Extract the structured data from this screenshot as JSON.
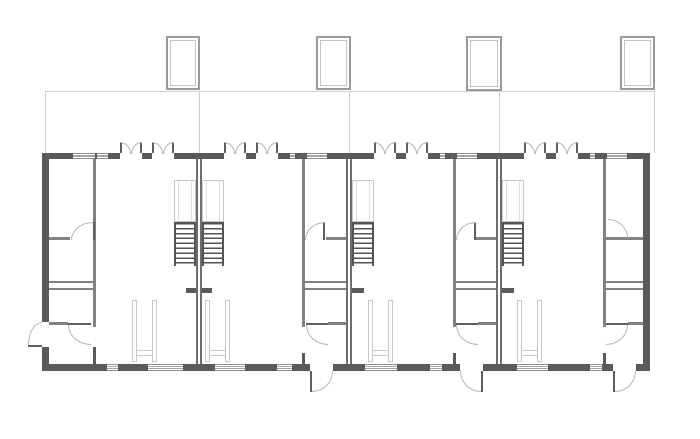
{
  "scene": {
    "width": 700,
    "height": 439,
    "background": "#ffffff"
  },
  "colors": {
    "exterior_wall": "#5a5a5a",
    "interior_wall": "#828282",
    "faint_line": "#cfcfcf",
    "door_arc": "#b5b5b5",
    "door_leaf": "#5f5f5f",
    "furniture_outline": "#c9c9c9"
  },
  "roof_objects": {
    "chimneys": [
      [
        166,
        36,
        34,
        54
      ],
      [
        316,
        36,
        35,
        54
      ],
      [
        466,
        36,
        36,
        55
      ],
      [
        620,
        36,
        35,
        54
      ]
    ]
  },
  "garden": {
    "hline": [
      45,
      91,
      610,
      1
    ],
    "vlines": [
      [
        45,
        91,
        1,
        62
      ],
      [
        199,
        91,
        1,
        62
      ],
      [
        349,
        91,
        1,
        62
      ],
      [
        499,
        91,
        1,
        62
      ],
      [
        654,
        91,
        1,
        62
      ]
    ]
  },
  "exterior_walls": [
    [
      42,
      153,
      608,
      6
    ],
    [
      42,
      364,
      608,
      7
    ],
    [
      42,
      153,
      7,
      218
    ],
    [
      643,
      153,
      7,
      218
    ]
  ],
  "top_openings": {
    "y": 153,
    "h": 6,
    "windows": [
      [
        73,
        22
      ],
      [
        97,
        11
      ],
      [
        290,
        5
      ],
      [
        307,
        20
      ],
      [
        440,
        5
      ],
      [
        457,
        20
      ],
      [
        590,
        5
      ],
      [
        607,
        20
      ]
    ],
    "doors": [
      [
        120,
        22
      ],
      [
        152,
        22
      ],
      [
        224,
        22
      ],
      [
        256,
        22
      ],
      [
        374,
        22
      ],
      [
        406,
        22
      ],
      [
        524,
        22
      ],
      [
        556,
        22
      ]
    ]
  },
  "bottom_openings": {
    "y": 364,
    "h": 7,
    "windows": [
      [
        107,
        11
      ],
      [
        148,
        35
      ],
      [
        215,
        30
      ],
      [
        277,
        15
      ],
      [
        365,
        32
      ],
      [
        430,
        12
      ],
      [
        517,
        31
      ],
      [
        590,
        12
      ]
    ],
    "doors": [
      [
        310,
        23
      ],
      [
        460,
        23
      ],
      [
        613,
        23
      ]
    ]
  },
  "side_openings": [
    [
      42,
      322,
      7,
      25
    ]
  ],
  "party_walls": [
    [
      196,
      159,
      6,
      205
    ],
    [
      346,
      159,
      6,
      205
    ],
    [
      496,
      159,
      6,
      205
    ]
  ],
  "partitions": [
    [
      93,
      159,
      3,
      168
    ],
    [
      302,
      159,
      3,
      168
    ],
    [
      453,
      159,
      3,
      168
    ],
    [
      603,
      159,
      3,
      168
    ]
  ],
  "room_walls": [
    [
      49,
      237,
      21,
      3
    ],
    [
      326,
      237,
      20,
      3
    ],
    [
      476,
      237,
      20,
      3
    ],
    [
      605,
      237,
      38,
      3
    ],
    [
      49,
      281,
      44,
      1.5
    ],
    [
      305,
      281,
      41,
      1.5
    ],
    [
      455,
      281,
      41,
      1.5
    ],
    [
      605,
      281,
      38,
      1.5
    ],
    [
      49,
      288,
      44,
      1.5
    ],
    [
      305,
      288,
      41,
      1.5
    ],
    [
      455,
      288,
      41,
      1.5
    ],
    [
      605,
      288,
      38,
      1.5
    ],
    [
      49,
      322,
      19,
      3
    ],
    [
      328,
      322,
      18,
      3
    ],
    [
      478,
      322,
      18,
      3
    ],
    [
      628,
      322,
      15,
      3
    ]
  ],
  "wall_stubs": [
    [
      186,
      288,
      10,
      5
    ],
    [
      202,
      288,
      10,
      5
    ],
    [
      352,
      288,
      12,
      5
    ],
    [
      502,
      288,
      12,
      5
    ],
    [
      93,
      347,
      3,
      17
    ],
    [
      302,
      353,
      3,
      11
    ],
    [
      453,
      353,
      3,
      11
    ],
    [
      603,
      353,
      3,
      11
    ]
  ],
  "stairs": {
    "flights_x": [
      174,
      202,
      352,
      502
    ],
    "width": 22,
    "upper": {
      "y": 180,
      "h": 42
    },
    "treads": {
      "y": 222,
      "h": 44
    }
  },
  "furniture_units": {
    "x": [
      132,
      205,
      368,
      517
    ],
    "y": 300,
    "h": 62,
    "leg_w": 5,
    "span": 25,
    "bar_y": 350,
    "bar_h": 6
  },
  "french_doors": {
    "leaf_len": 11,
    "y": 142,
    "h": 12
  },
  "door_swings": [
    {
      "leaf": [
        93,
        222,
        2,
        18
      ],
      "arc": [
        71,
        222,
        22,
        18
      ],
      "dir": "nw"
    },
    {
      "leaf": [
        323,
        222,
        2,
        18
      ],
      "arc": [
        305,
        222,
        20,
        18
      ],
      "dir": "nw"
    },
    {
      "leaf": [
        474,
        222,
        2,
        18
      ],
      "arc": [
        456,
        222,
        20,
        18
      ],
      "dir": "nw"
    },
    {
      "leaf": null,
      "arc": [
        608,
        219,
        20,
        19
      ],
      "dir": "ne"
    },
    {
      "leaf": [
        68,
        323,
        23,
        2
      ],
      "arc": [
        68,
        325,
        23,
        20
      ],
      "dir": "sw"
    },
    {
      "leaf": [
        306,
        323,
        22,
        2
      ],
      "arc": [
        306,
        325,
        22,
        20
      ],
      "dir": "sw"
    },
    {
      "leaf": [
        456,
        323,
        22,
        2
      ],
      "arc": [
        456,
        325,
        22,
        20
      ],
      "dir": "sw"
    },
    {
      "leaf": [
        606,
        323,
        22,
        2
      ],
      "arc": [
        606,
        325,
        22,
        20
      ],
      "dir": "se"
    },
    {
      "leaf": [
        310,
        371,
        2,
        21
      ],
      "arc": [
        312,
        371,
        21,
        21
      ],
      "dir": "se"
    },
    {
      "leaf": [
        481,
        371,
        2,
        21
      ],
      "arc": [
        460,
        371,
        21,
        21
      ],
      "dir": "sw"
    },
    {
      "leaf": [
        613,
        371,
        2,
        21
      ],
      "arc": [
        615,
        371,
        21,
        21
      ],
      "dir": "se"
    },
    {
      "leaf": [
        28,
        345,
        14,
        2
      ],
      "arc": [
        28,
        322,
        14,
        23
      ],
      "dir": "nw"
    }
  ]
}
